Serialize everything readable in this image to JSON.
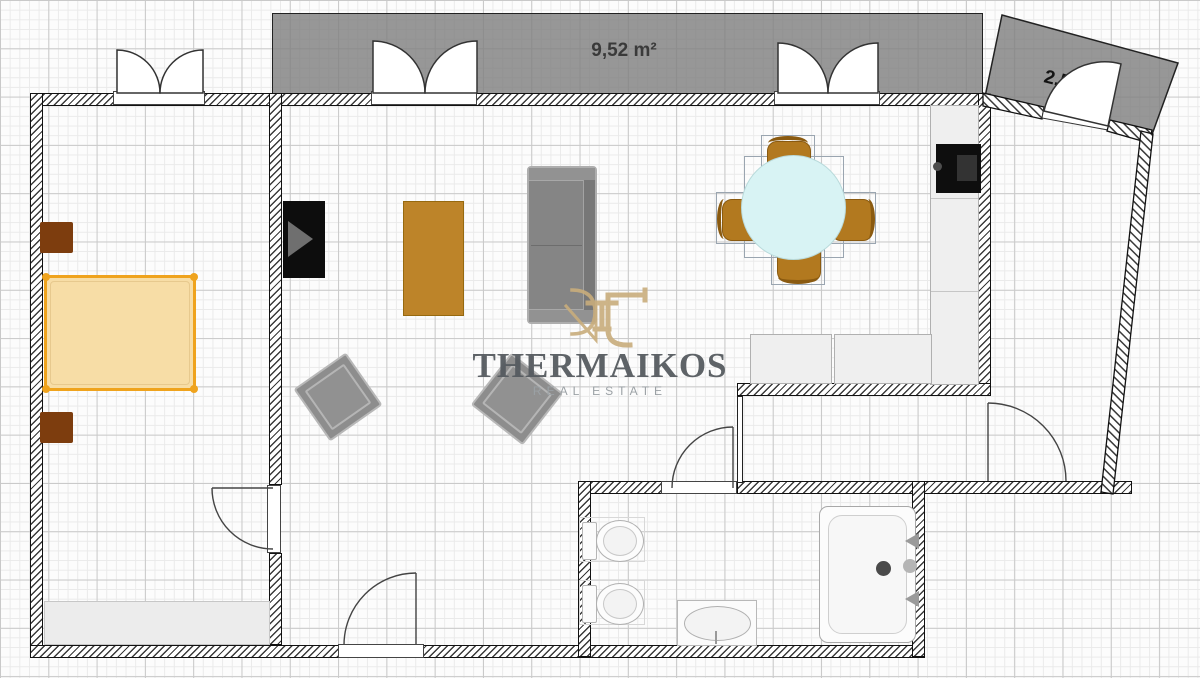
{
  "plan": {
    "balcony_large_label": "9,52 m²",
    "balcony_small_label": "2,51 m²"
  },
  "watermark": {
    "title": "THERMAIKOS",
    "subtitle": "REAL ESTATE"
  },
  "colors": {
    "balcony_fill": "#848484",
    "wall_line": "#111111",
    "bed_accent": "#efa31d",
    "bed_fill": "#f7dda6",
    "wood_brown": "#bd8429",
    "nightstand_brown": "#7d3d0e",
    "dining_table_fill": "#d8f3f4",
    "sofa_gray": "#858585",
    "cooktop_black": "#0e0e0e",
    "watermark_gold": "#c9ad7c",
    "watermark_text": "#565b60",
    "watermark_subtext": "#9ba1a5"
  },
  "items": [
    "double-bed",
    "nightstand",
    "nightstand",
    "wardrobe",
    "tv",
    "coffee-table",
    "sofa",
    "armchair",
    "armchair",
    "dining-table",
    "dining-chair",
    "dining-chair",
    "dining-chair",
    "dining-chair",
    "kitchen-counter",
    "kitchen-counter",
    "kitchen-counter",
    "cooktop",
    "toilet",
    "toilet",
    "washbasin",
    "bathtub",
    "balcony",
    "balcony"
  ]
}
